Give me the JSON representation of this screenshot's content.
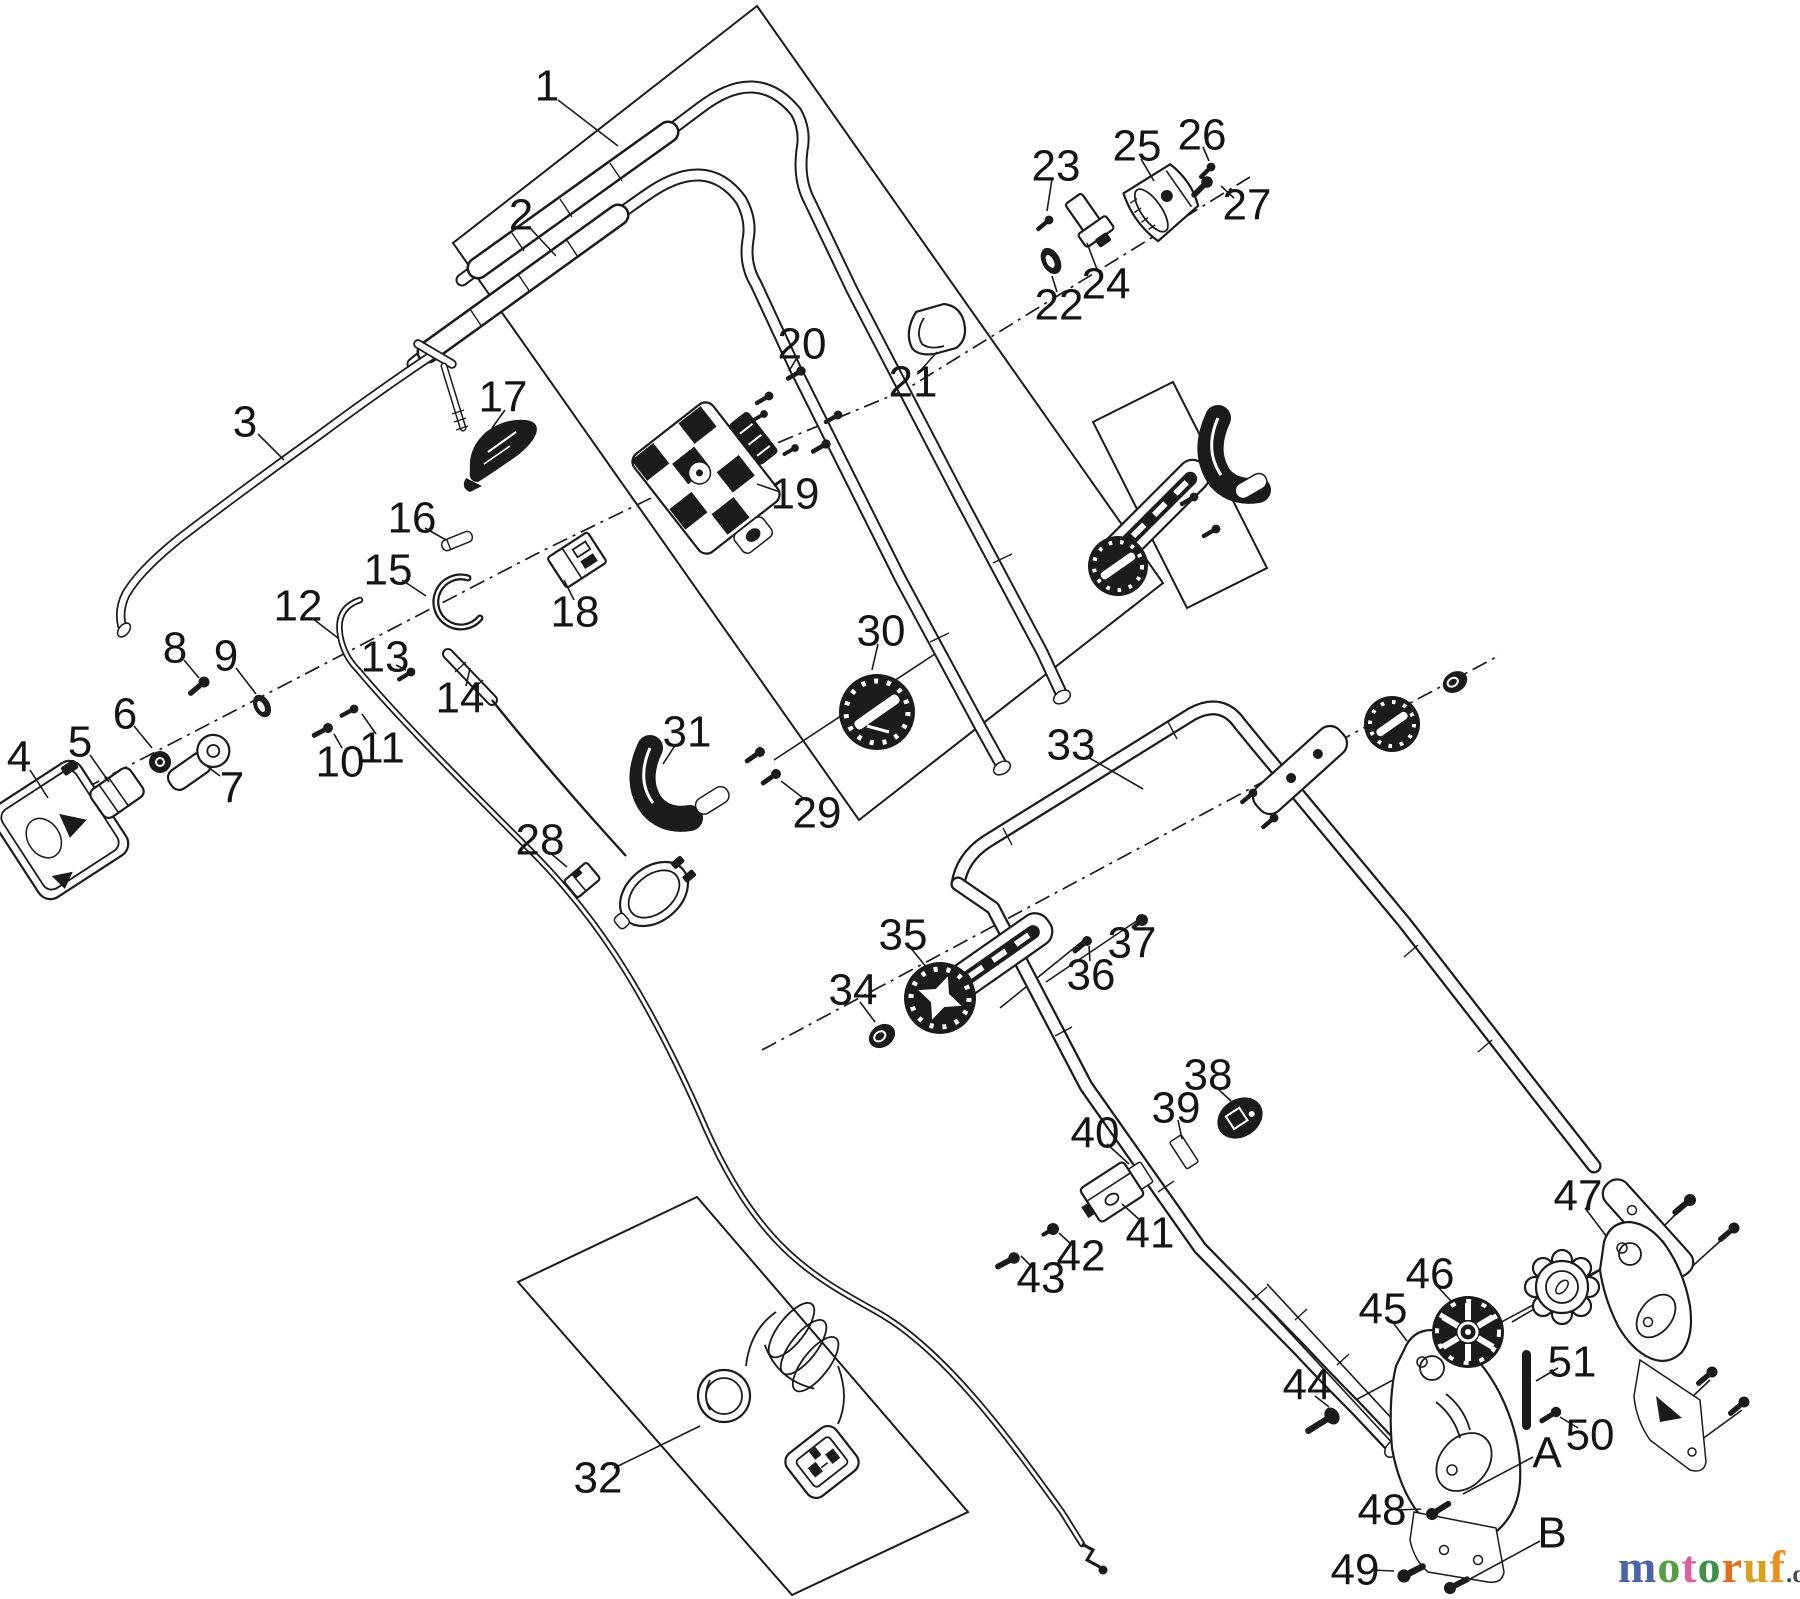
{
  "diagram_type": "exploded-parts-diagram",
  "parts": {
    "labels": [
      {
        "id": "1",
        "text": "1",
        "x": 547,
        "y": 86,
        "leader": [
          558,
          100,
          618,
          146
        ]
      },
      {
        "id": "2",
        "text": "2",
        "x": 521,
        "y": 215,
        "leader": [
          530,
          228,
          556,
          256
        ]
      },
      {
        "id": "3",
        "text": "3",
        "x": 245,
        "y": 422,
        "leader": [
          258,
          434,
          284,
          460
        ]
      },
      {
        "id": "4",
        "text": "4",
        "x": 19,
        "y": 757,
        "leader": [
          30,
          770,
          48,
          798
        ]
      },
      {
        "id": "5",
        "text": "5",
        "x": 80,
        "y": 742,
        "leader": [
          90,
          755,
          109,
          782
        ]
      },
      {
        "id": "6",
        "text": "6",
        "x": 125,
        "y": 714,
        "leader": [
          134,
          726,
          152,
          748
        ]
      },
      {
        "id": "7",
        "text": "7",
        "x": 232,
        "y": 788,
        "leader": [
          220,
          776,
          200,
          761
        ]
      },
      {
        "id": "8",
        "text": "8",
        "x": 175,
        "y": 648,
        "leader": [
          184,
          660,
          199,
          678
        ]
      },
      {
        "id": "9",
        "text": "9",
        "x": 226,
        "y": 656,
        "leader": [
          236,
          668,
          256,
          694
        ]
      },
      {
        "id": "10",
        "text": "10",
        "x": 340,
        "y": 762,
        "leader": [
          342,
          748,
          334,
          734
        ]
      },
      {
        "id": "11",
        "text": "11",
        "x": 382,
        "y": 748,
        "leader": [
          376,
          734,
          362,
          714
        ]
      },
      {
        "id": "12",
        "text": "12",
        "x": 298,
        "y": 606,
        "leader": [
          312,
          618,
          338,
          638
        ]
      },
      {
        "id": "13",
        "text": "13",
        "x": 385,
        "y": 657,
        "leader": [
          396,
          665,
          406,
          670
        ]
      },
      {
        "id": "14",
        "text": "14",
        "x": 460,
        "y": 698,
        "leader": [
          466,
          686,
          470,
          668
        ]
      },
      {
        "id": "15",
        "text": "15",
        "x": 388,
        "y": 570,
        "leader": [
          402,
          580,
          426,
          596
        ]
      },
      {
        "id": "16",
        "text": "16",
        "x": 412,
        "y": 518,
        "leader": [
          425,
          528,
          446,
          540
        ]
      },
      {
        "id": "17",
        "text": "17",
        "x": 503,
        "y": 397,
        "leader": [
          505,
          410,
          492,
          428
        ]
      },
      {
        "id": "18",
        "text": "18",
        "x": 575,
        "y": 612,
        "leader": [
          574,
          600,
          564,
          580
        ]
      },
      {
        "id": "19",
        "text": "19",
        "x": 795,
        "y": 494,
        "leader": [
          780,
          492,
          757,
          484
        ]
      },
      {
        "id": "20",
        "text": "20",
        "x": 802,
        "y": 344,
        "leader": [
          798,
          356,
          789,
          371
        ]
      },
      {
        "id": "21",
        "text": "21",
        "x": 913,
        "y": 382,
        "leader": [
          921,
          370,
          937,
          352
        ]
      },
      {
        "id": "22",
        "text": "22",
        "x": 1059,
        "y": 305,
        "leader": [
          1057,
          292,
          1052,
          276
        ]
      },
      {
        "id": "23",
        "text": "23",
        "x": 1056,
        "y": 166,
        "leader": [
          1052,
          179,
          1047,
          211
        ]
      },
      {
        "id": "24",
        "text": "24",
        "x": 1106,
        "y": 284,
        "leader": [
          1098,
          272,
          1087,
          243
        ]
      },
      {
        "id": "25",
        "text": "25",
        "x": 1137,
        "y": 146,
        "leader": [
          1141,
          159,
          1154,
          181
        ]
      },
      {
        "id": "26",
        "text": "26",
        "x": 1202,
        "y": 135,
        "leader": [
          1203,
          147,
          1209,
          161
        ]
      },
      {
        "id": "27",
        "text": "27",
        "x": 1247,
        "y": 205,
        "leader": [
          1234,
          198,
          1221,
          186
        ]
      },
      {
        "id": "28",
        "text": "28",
        "x": 540,
        "y": 840,
        "leader": [
          549,
          852,
          567,
          867
        ]
      },
      {
        "id": "29",
        "text": "29",
        "x": 817,
        "y": 813,
        "leader": [
          807,
          801,
          781,
          781
        ]
      },
      {
        "id": "30",
        "text": "30",
        "x": 881,
        "y": 631,
        "leader": [
          878,
          644,
          872,
          670
        ]
      },
      {
        "id": "31",
        "text": "31",
        "x": 687,
        "y": 732,
        "leader": [
          676,
          744,
          663,
          764
        ]
      },
      {
        "id": "32",
        "text": "32",
        "x": 598,
        "y": 1478,
        "leader": [
          614,
          1468,
          700,
          1426
        ]
      },
      {
        "id": "33",
        "text": "33",
        "x": 1071,
        "y": 745,
        "leader": [
          1086,
          756,
          1143,
          789
        ]
      },
      {
        "id": "34",
        "text": "34",
        "x": 853,
        "y": 990,
        "leader": [
          860,
          1002,
          875,
          1022
        ]
      },
      {
        "id": "35",
        "text": "35",
        "x": 903,
        "y": 935,
        "leader": [
          910,
          947,
          927,
          968
        ]
      },
      {
        "id": "36",
        "text": "36",
        "x": 1091,
        "y": 975,
        "leader": [
          1090,
          961,
          1089,
          946
        ]
      },
      {
        "id": "37",
        "text": "37",
        "x": 1132,
        "y": 943,
        "leader": [
          1134,
          930,
          1141,
          919
        ]
      },
      {
        "id": "38",
        "text": "38",
        "x": 1208,
        "y": 1075,
        "leader": [
          1216,
          1087,
          1231,
          1101
        ]
      },
      {
        "id": "39",
        "text": "39",
        "x": 1176,
        "y": 1108,
        "leader": [
          1178,
          1120,
          1182,
          1139
        ]
      },
      {
        "id": "40",
        "text": "40",
        "x": 1095,
        "y": 1133,
        "leader": [
          1107,
          1144,
          1129,
          1164
        ]
      },
      {
        "id": "41",
        "text": "41",
        "x": 1150,
        "y": 1233,
        "leader": [
          1141,
          1221,
          1122,
          1204
        ]
      },
      {
        "id": "42",
        "text": "42",
        "x": 1081,
        "y": 1256,
        "leader": [
          1072,
          1245,
          1059,
          1233
        ]
      },
      {
        "id": "43",
        "text": "43",
        "x": 1041,
        "y": 1278,
        "leader": [
          1032,
          1267,
          1021,
          1256
        ]
      },
      {
        "id": "44",
        "text": "44",
        "x": 1307,
        "y": 1385,
        "leader": [
          1315,
          1396,
          1329,
          1407
        ]
      },
      {
        "id": "45",
        "text": "45",
        "x": 1383,
        "y": 1309,
        "leader": [
          1391,
          1320,
          1407,
          1341
        ]
      },
      {
        "id": "46",
        "text": "46",
        "x": 1430,
        "y": 1274,
        "leader": [
          1437,
          1286,
          1451,
          1301
        ]
      },
      {
        "id": "47",
        "text": "47",
        "x": 1578,
        "y": 1196,
        "leader": [
          1585,
          1208,
          1607,
          1237
        ]
      },
      {
        "id": "48",
        "text": "48",
        "x": 1382,
        "y": 1510,
        "leader": [
          1398,
          1510,
          1421,
          1509
        ]
      },
      {
        "id": "49",
        "text": "49",
        "x": 1355,
        "y": 1570,
        "leader": [
          1371,
          1570,
          1394,
          1571
        ]
      },
      {
        "id": "50",
        "text": "50",
        "x": 1590,
        "y": 1435,
        "leader": [
          1578,
          1428,
          1560,
          1417
        ]
      },
      {
        "id": "51",
        "text": "51",
        "x": 1572,
        "y": 1362,
        "leader": [
          1558,
          1368,
          1536,
          1381
        ]
      },
      {
        "id": "A",
        "text": "A",
        "x": 1547,
        "y": 1453,
        "leader": [
          1533,
          1457,
          1463,
          1494
        ]
      },
      {
        "id": "B",
        "text": "B",
        "x": 1552,
        "y": 1533,
        "leader": [
          1540,
          1541,
          1459,
          1585
        ]
      }
    ]
  },
  "watermark": {
    "letters": [
      {
        "ch": "m",
        "color": "#4a63ae"
      },
      {
        "ch": "o",
        "color": "#55a045"
      },
      {
        "ch": "t",
        "color": "#dc5f9f"
      },
      {
        "ch": "o",
        "color": "#3f8f49"
      },
      {
        "ch": "r",
        "color": "#e4701c"
      },
      {
        "ch": "u",
        "color": "#d8a21c"
      },
      {
        "ch": "f",
        "color": "#f08d1a"
      }
    ],
    "suffix": ".de",
    "suffix_color": "#4a4a4a"
  }
}
